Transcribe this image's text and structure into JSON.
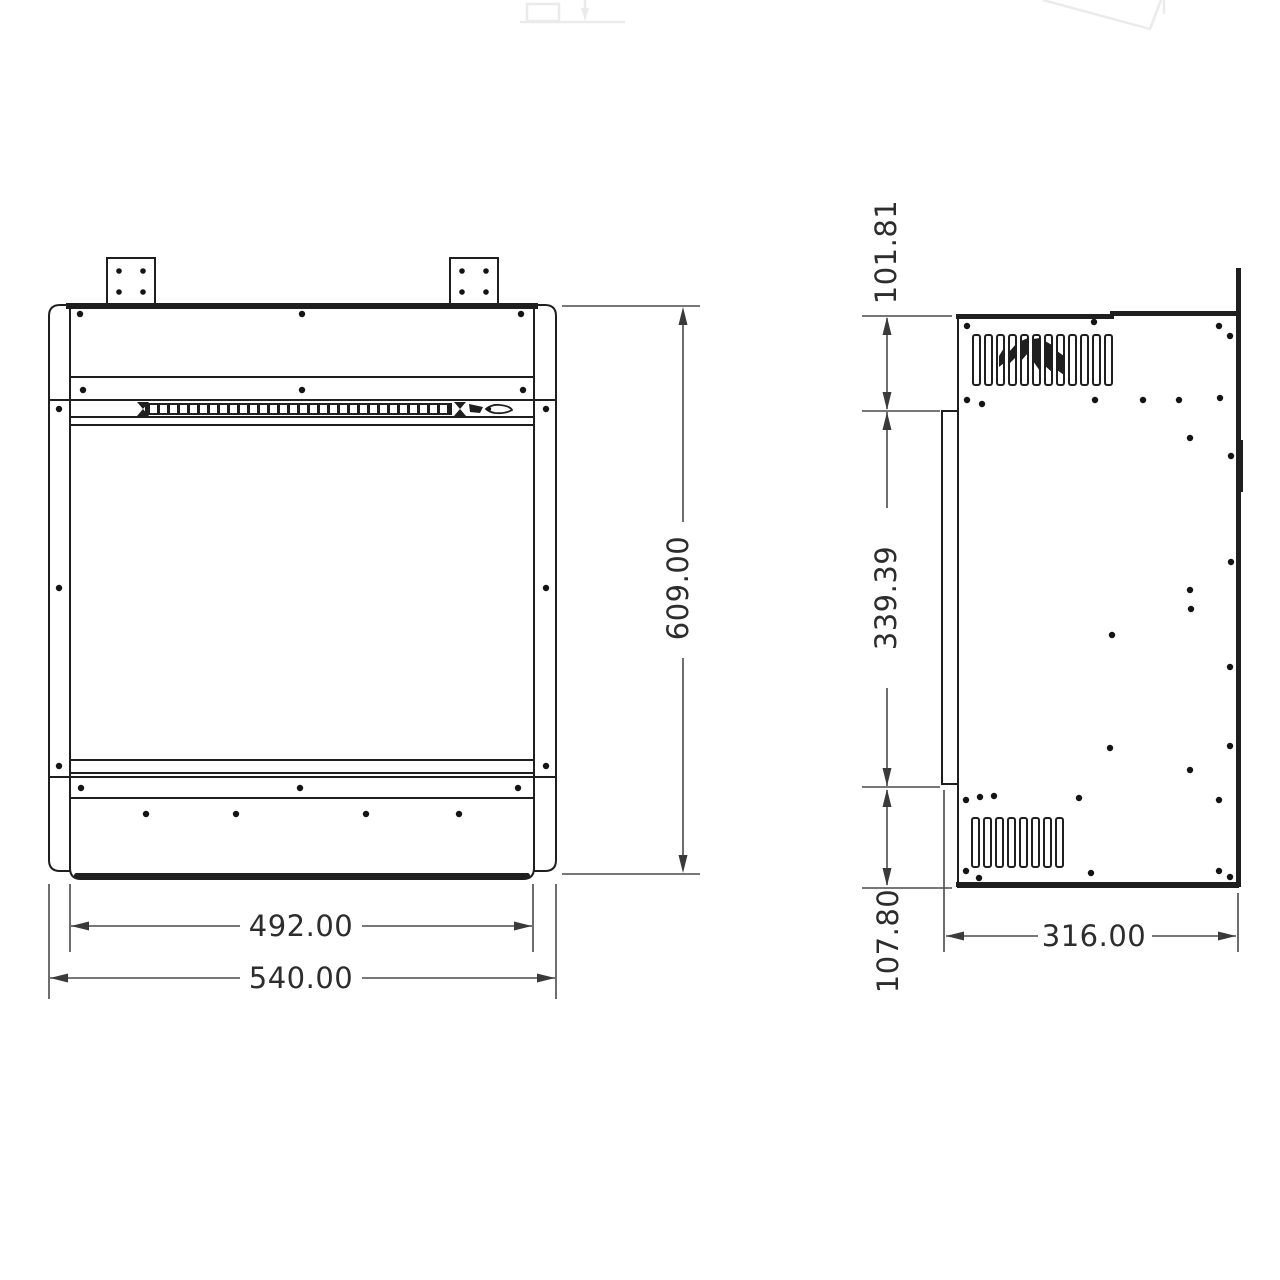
{
  "drawing": {
    "type": "technical-dimension-drawing",
    "views": [
      "front-view",
      "side-view"
    ],
    "background": "#ffffff",
    "line_color": "#1f1f1f",
    "dimension_line_color": "#4a4a4a",
    "text_color": "#2d2d2d",
    "front_view": {
      "dimensions": {
        "height": "609.00",
        "opening_width": "492.00",
        "overall_width": "540.00"
      }
    },
    "side_view": {
      "dimensions": {
        "top_section": "101.81",
        "glass_section": "339.39",
        "bottom_section": "107.80",
        "depth": "316.00"
      }
    }
  }
}
